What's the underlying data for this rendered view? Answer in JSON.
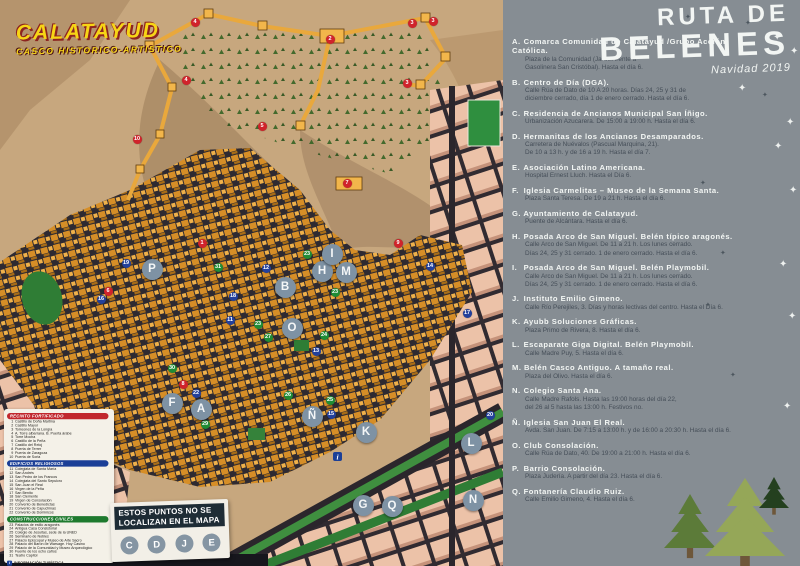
{
  "map": {
    "title": "CALATAYUD",
    "subtitle": "CASCO HISTORICO-ARTISTICO",
    "not_localized": {
      "text": "ESTOS PUNTOS NO SE LOCALIZAN EN EL MAPA",
      "letters": [
        "C",
        "D",
        "J",
        "E"
      ]
    },
    "legend": {
      "sections": [
        {
          "title": "RECINTO FORTIFICADO",
          "color": "#c1272d",
          "start": 1,
          "items": [
            "Castillo de Doña Martina",
            "Castillo Mayor",
            "Torreones de la Longía",
            "A. Torre albarrana. B. Puerta árabe",
            "Torre Mocha",
            "Castillo de la Peña",
            "Castillo del Reloj",
            "Puerta de Terrer",
            "Puerta de Zaragoza",
            "Puerta de Soria"
          ]
        },
        {
          "title": "EDIFICIOS RELIGIOSOS",
          "color": "#1b3f97",
          "start": 11,
          "items": [
            "Colegiata de Santa María",
            "San Andrés",
            "San Pedro de los Francos",
            "Colegiata del Santo Sepulcro",
            "San Juan el Real",
            "Virgen de la Peña",
            "San Benito",
            "San Clemente",
            "Virgen de Consolación",
            "Convento de Benedictas",
            "Convento de Capuchinas",
            "Convento de Dominicos"
          ]
        },
        {
          "title": "CONSTRUCCIONES CIVILES",
          "color": "#1e7a2e",
          "start": 23,
          "items": [
            "Palacios de estilo aragonés",
            "Antigua Casa Consistorial",
            "Colegio de Jesuitas, sede de la UNED",
            "Seminario de Nobles",
            "Palacio Episcopal y Museo de Arte Sacro",
            "Palacio del Barón de Warsage. Hoy Casino",
            "Palacio de la Comunidad y Museo Arqueológico",
            "Fuente de los ocho caños",
            "Teatro Capitol"
          ]
        }
      ],
      "footer": "INFORMACIÓN TURÍSTICA"
    },
    "letter_markers": [
      {
        "label": "A",
        "x": 201,
        "y": 409
      },
      {
        "label": "B",
        "x": 285,
        "y": 287
      },
      {
        "label": "F",
        "x": 172,
        "y": 403
      },
      {
        "label": "G",
        "x": 363,
        "y": 505
      },
      {
        "label": "H",
        "x": 322,
        "y": 271
      },
      {
        "label": "I",
        "x": 332,
        "y": 254
      },
      {
        "label": "K",
        "x": 366,
        "y": 432
      },
      {
        "label": "L",
        "x": 471,
        "y": 443
      },
      {
        "label": "M",
        "x": 346,
        "y": 272
      },
      {
        "label": "N",
        "x": 473,
        "y": 500
      },
      {
        "label": "Ñ",
        "x": 312,
        "y": 416
      },
      {
        "label": "O",
        "x": 292,
        "y": 328
      },
      {
        "label": "P",
        "x": 152,
        "y": 269
      },
      {
        "label": "Q",
        "x": 392,
        "y": 506
      }
    ],
    "number_markers": [
      {
        "n": "1",
        "x": 202,
        "y": 243,
        "c": "r"
      },
      {
        "n": "2",
        "x": 330,
        "y": 39,
        "c": "r"
      },
      {
        "n": "3",
        "x": 412,
        "y": 23,
        "c": "r"
      },
      {
        "n": "3",
        "x": 433,
        "y": 21,
        "c": "r"
      },
      {
        "n": "3",
        "x": 407,
        "y": 83,
        "c": "r"
      },
      {
        "n": "4",
        "x": 195,
        "y": 22,
        "c": "r"
      },
      {
        "n": "4",
        "x": 186,
        "y": 80,
        "c": "r"
      },
      {
        "n": "5",
        "x": 262,
        "y": 126,
        "c": "r"
      },
      {
        "n": "6",
        "x": 108,
        "y": 291,
        "c": "r"
      },
      {
        "n": "7",
        "x": 347,
        "y": 183,
        "c": "r"
      },
      {
        "n": "8",
        "x": 183,
        "y": 384,
        "c": "r"
      },
      {
        "n": "9",
        "x": 398,
        "y": 243,
        "c": "r"
      },
      {
        "n": "10",
        "x": 137,
        "y": 139,
        "c": "r"
      },
      {
        "n": "11",
        "x": 230,
        "y": 320,
        "c": "b"
      },
      {
        "n": "12",
        "x": 266,
        "y": 268,
        "c": "b"
      },
      {
        "n": "13",
        "x": 316,
        "y": 351,
        "c": "b"
      },
      {
        "n": "14",
        "x": 430,
        "y": 266,
        "c": "b"
      },
      {
        "n": "15",
        "x": 331,
        "y": 414,
        "c": "b"
      },
      {
        "n": "16",
        "x": 101,
        "y": 299,
        "c": "b"
      },
      {
        "n": "17",
        "x": 467,
        "y": 313,
        "c": "b"
      },
      {
        "n": "18",
        "x": 233,
        "y": 296,
        "c": "b"
      },
      {
        "n": "19",
        "x": 126,
        "y": 263,
        "c": "b"
      },
      {
        "n": "20",
        "x": 490,
        "y": 415,
        "c": "b"
      },
      {
        "n": "22",
        "x": 196,
        "y": 393,
        "c": "b"
      },
      {
        "n": "23",
        "x": 307,
        "y": 254,
        "c": "g"
      },
      {
        "n": "23",
        "x": 335,
        "y": 292,
        "c": "g"
      },
      {
        "n": "23",
        "x": 258,
        "y": 324,
        "c": "g"
      },
      {
        "n": "24",
        "x": 324,
        "y": 335,
        "c": "g"
      },
      {
        "n": "25",
        "x": 330,
        "y": 400,
        "c": "g"
      },
      {
        "n": "26",
        "x": 288,
        "y": 395,
        "c": "g"
      },
      {
        "n": "27",
        "x": 268,
        "y": 337,
        "c": "g"
      },
      {
        "n": "29",
        "x": 205,
        "y": 424,
        "c": "g"
      },
      {
        "n": "30",
        "x": 172,
        "y": 368,
        "c": "g"
      },
      {
        "n": "31",
        "x": 218,
        "y": 267,
        "c": "g"
      }
    ]
  },
  "panel": {
    "title_line1": "RUTA DE",
    "title_line2": "BELENES",
    "subtitle": "Navidad 2019",
    "entries": [
      {
        "letter": "A",
        "name": "Comarca Comunidad de Calatayud /Grupo Acción Católica.",
        "details": [
          "Plaza de la Comunidad (Jardín frente a",
          "Gasolinera San Cristóbal). Hasta el día 6."
        ]
      },
      {
        "letter": "B",
        "name": "Centro de Día (DGA).",
        "details": [
          "Calle Rúa de Dato de 10 A 20 horas. Días 24, 25 y 31 de",
          "diciembre cerrado, día 1 de enero cerrado. Hasta el día 6."
        ]
      },
      {
        "letter": "C",
        "name": "Residencia de Ancianos Municipal San Íñigo.",
        "details": [
          "Urbanización Azucarera. De 15:00 a 19:00 h. Hasta el día 6."
        ]
      },
      {
        "letter": "D",
        "name": "Hermanitas de los Ancianos Desamparados.",
        "details": [
          "Carretera de Nuévalos (Pascual Marquina, 21).",
          "De 10 a 13 h. y de 16 a 19 h. Hasta el día 7."
        ]
      },
      {
        "letter": "E",
        "name": "Asociación Latino Americana.",
        "details": [
          "Hospital Ernest Lluch. Hasta el Día 6."
        ]
      },
      {
        "letter": "F",
        "name": "Iglesia Carmelitas – Museo de la Semana Santa.",
        "details": [
          "Plaza Santa Teresa. De 19 a 21 h. Hasta el día 6."
        ]
      },
      {
        "letter": "G",
        "name": "Ayuntamiento de Calatayud.",
        "details": [
          "Puente de Alcántara. Hasta el día 6."
        ]
      },
      {
        "letter": "H",
        "name": "Posada Arco de San Miguel. Belén típico aragonés.",
        "details": [
          "Calle Arco de San Miguel. De 11 a 21 h. Los lunes cerrado.",
          "Días 24, 25 y 31 cerrado. 1 de enero cerrado. Hasta el día 6."
        ]
      },
      {
        "letter": "I",
        "name": "Posada Arco de San Miguel. Belén Playmobil.",
        "details": [
          "Calle Arco de San Miguel. De 11 a 21 h. Los lunes cerrado.",
          "Días 24, 25 y 31 cerrado. 1 de enero cerrado. Hasta el día 6."
        ]
      },
      {
        "letter": "J",
        "name": "Instituto Emilio Gimeno.",
        "details": [
          "Calle Río Perejiles, 3. Días y horas lectivas del centro. Hasta el Día 6."
        ]
      },
      {
        "letter": "K",
        "name": "Ayubb Soluciones Gráficas.",
        "details": [
          "Plaza Primo de Rivera, 8. Hasta el día 6."
        ]
      },
      {
        "letter": "L",
        "name": "Escaparate Giga Digital. Belén Playmobil.",
        "details": [
          "Calle Madre Puy, 5. Hasta el día 6."
        ]
      },
      {
        "letter": "M",
        "name": "Belén Casco Antiguo. A tamaño real.",
        "details": [
          "Plaza del Olivo. Hasta el día 6."
        ]
      },
      {
        "letter": "N",
        "name": "Colegio Santa Ana.",
        "details": [
          "Calle Madre Rafols. Hasta las 19:00 horas del día 22,",
          "del 26 al 5 hasta las 13:00 h. Festivos no."
        ]
      },
      {
        "letter": "Ñ",
        "name": "Iglesia San Juan El Real.",
        "details": [
          "Avda. San Juan. De 7:15 a 13:00 h. y de 16:00 a 20:30 h. Hasta el día 6."
        ]
      },
      {
        "letter": "O",
        "name": "Club Consolación.",
        "details": [
          "Calle Rúa de Dato, 40. De 19:00 a 21:00 h. Hasta el día 6."
        ]
      },
      {
        "letter": "P",
        "name": "Barrio Consolación.",
        "details": [
          "Plaza Judería. A partir del día 23. Hasta el día 6."
        ]
      },
      {
        "letter": "Q",
        "name": "Fontanería Claudio Ruiz.",
        "details": [
          "Calle Emilio Gimeno, 4. Hasta el día 6."
        ]
      }
    ],
    "stars": [
      {
        "x": 685,
        "y": 14,
        "c": "d"
      },
      {
        "x": 745,
        "y": 20,
        "c": "d"
      },
      {
        "x": 773,
        "y": 33,
        "c": "w"
      },
      {
        "x": 790,
        "y": 47,
        "c": "w"
      },
      {
        "x": 738,
        "y": 84,
        "c": "w"
      },
      {
        "x": 762,
        "y": 92,
        "c": "d"
      },
      {
        "x": 786,
        "y": 118,
        "c": "w"
      },
      {
        "x": 774,
        "y": 142,
        "c": "w"
      },
      {
        "x": 700,
        "y": 180,
        "c": "d"
      },
      {
        "x": 789,
        "y": 186,
        "c": "w"
      },
      {
        "x": 720,
        "y": 250,
        "c": "d"
      },
      {
        "x": 779,
        "y": 260,
        "c": "w"
      },
      {
        "x": 705,
        "y": 302,
        "c": "d"
      },
      {
        "x": 788,
        "y": 312,
        "c": "w"
      },
      {
        "x": 730,
        "y": 372,
        "c": "d"
      },
      {
        "x": 783,
        "y": 402,
        "c": "w"
      }
    ],
    "trees": [
      {
        "cx": 690,
        "top": 494,
        "base": 548,
        "hw": 26,
        "color": "#5c7b39"
      },
      {
        "cx": 745,
        "top": 478,
        "base": 556,
        "hw": 40,
        "color": "#95a758"
      },
      {
        "cx": 774,
        "top": 477,
        "base": 508,
        "hw": 15,
        "color": "#24401f"
      }
    ]
  },
  "colors": {
    "panel_bg": "#868d93",
    "detail_text": "#454e58",
    "title_text": "#f3f6f4",
    "marker_letter_bg": "#7e92a4",
    "marker_red": "#d0232b",
    "marker_blue": "#23409b",
    "marker_green": "#1f8c35",
    "map_hill": "#c7a77e",
    "buildings": "#d68e27",
    "modern_blocks": "#ecc2a8",
    "park_green": "#2f7d35",
    "star_white": "#eef1ef",
    "star_dark": "#4c565e"
  }
}
